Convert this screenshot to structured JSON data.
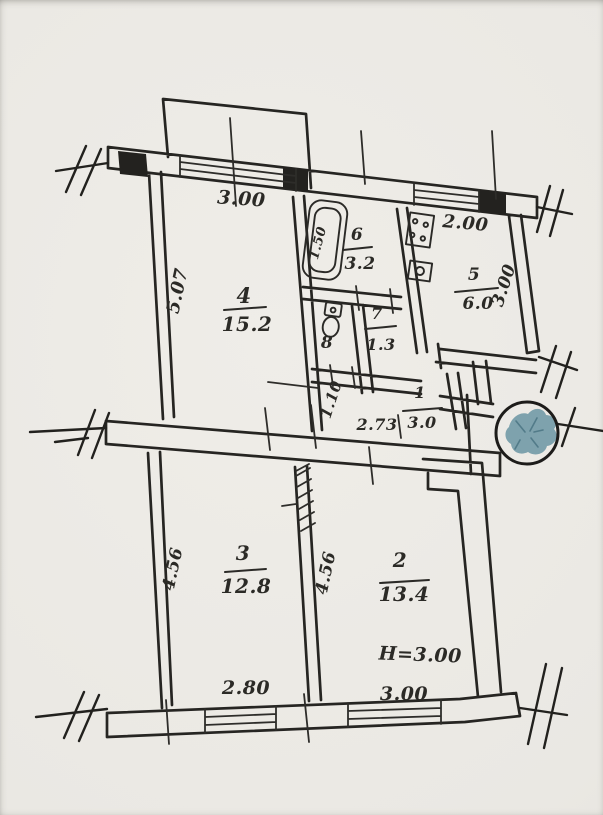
{
  "plan": {
    "rooms": [
      {
        "number": "1",
        "area": "3.0"
      },
      {
        "number": "2",
        "area": "13.4"
      },
      {
        "number": "3",
        "area": "12.8"
      },
      {
        "number": "4",
        "area": "15.2"
      },
      {
        "number": "5",
        "area": "6.0"
      },
      {
        "number": "6",
        "area": "3.2"
      },
      {
        "number": "7",
        "area": "1.3"
      },
      {
        "number": "8",
        "area": ""
      }
    ],
    "dimensions": {
      "room4_top": "3.00",
      "room4_left": "5.07",
      "kitchen_top": "2.00",
      "kitchen_right": "3.00",
      "bathtub": "1.50",
      "hallway_width": "2.73",
      "hallway_depth": "1.10",
      "room3_left": "4.56",
      "room2_mid": "4.56",
      "room3_bottom": "2.80",
      "room2_bottom": "3.00",
      "ceiling_height": "Н=3.00"
    },
    "colors": {
      "ink": "#262522",
      "paper": "#ebe9e4",
      "stamp": "#6e97a5"
    },
    "icons": [
      "bathtub-icon",
      "toilet-icon",
      "stove-icon",
      "sink-icon",
      "stamp-icon"
    ]
  }
}
